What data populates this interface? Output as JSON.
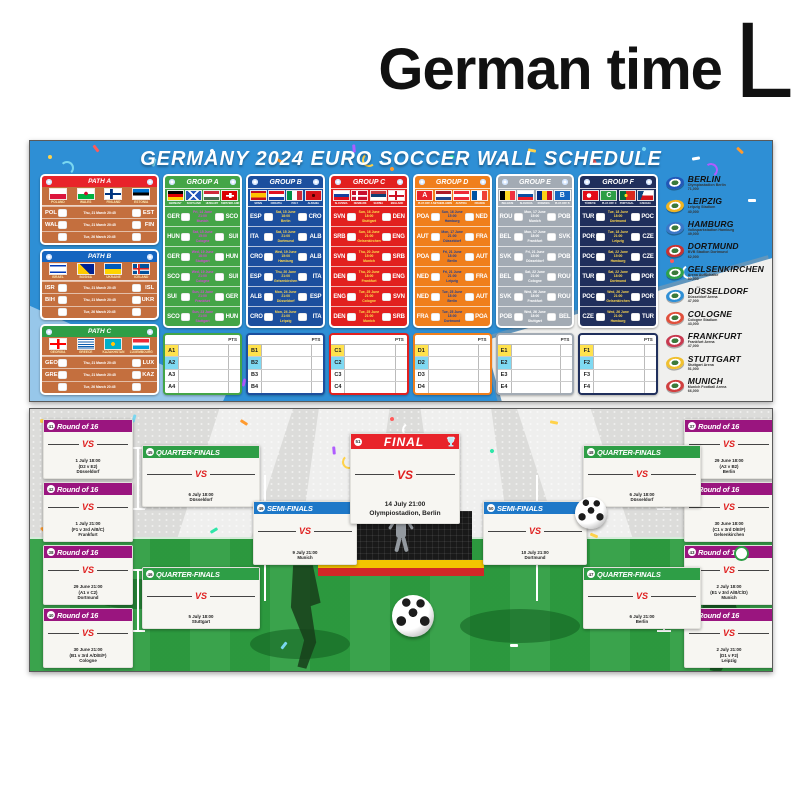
{
  "header": {
    "title": "German time",
    "size": "L"
  },
  "top_banner": {
    "title": "GERMANY 2024 EURO SOCCER WALL SCHEDULE",
    "pts_label": "PTS",
    "paths": [
      {
        "name": "PATH A",
        "color": "#e8232a",
        "flags": [
          {
            "code": "pol",
            "label": "POLAND"
          },
          {
            "code": "wal",
            "label": "WALES"
          },
          {
            "code": "fin",
            "label": "FINLAND"
          },
          {
            "code": "est",
            "label": "ESTONIA"
          }
        ],
        "matches": [
          {
            "home": "POL",
            "away": "EST",
            "info": "Thu, 21 March 20:45"
          },
          {
            "home": "WAL",
            "away": "FIN",
            "info": "Thu, 21 March 20:45"
          },
          {
            "home": "",
            "away": "",
            "info": "Tue, 26 March 20:45"
          }
        ]
      },
      {
        "name": "PATH B",
        "color": "#1565c0",
        "flags": [
          {
            "code": "isr",
            "label": "ISRAEL"
          },
          {
            "code": "bih",
            "label": "BOSNIA"
          },
          {
            "code": "ukr",
            "label": "UKRAINE"
          },
          {
            "code": "isl",
            "label": "ICELAND"
          }
        ],
        "matches": [
          {
            "home": "ISR",
            "away": "ISL",
            "info": "Thu, 21 March 20:45"
          },
          {
            "home": "BIH",
            "away": "UKR",
            "info": "Thu, 21 March 20:45"
          },
          {
            "home": "",
            "away": "",
            "info": "Tue, 26 March 20:45"
          }
        ]
      },
      {
        "name": "PATH C",
        "color": "#2e9e46",
        "flags": [
          {
            "code": "geo",
            "label": "GEORGIA"
          },
          {
            "code": "gre",
            "label": "GREECE"
          },
          {
            "code": "kaz",
            "label": "KAZAKHSTAN"
          },
          {
            "code": "lux",
            "label": "LUXEMBOURG"
          }
        ],
        "matches": [
          {
            "home": "GEO",
            "away": "LUX",
            "info": "Thu, 21 March 20:45"
          },
          {
            "home": "GRE",
            "away": "KAZ",
            "info": "Thu, 21 March 20:45"
          },
          {
            "home": "",
            "away": "",
            "info": "Tue, 26 March 20:45"
          }
        ]
      }
    ],
    "groups": [
      {
        "name": "GROUP A",
        "color": "#44a547",
        "info_color": "#d24ad2",
        "flags": [
          {
            "code": "ger",
            "label": "GERMANY"
          },
          {
            "code": "sco",
            "label": "SCOTLAND"
          },
          {
            "code": "hun",
            "label": "HUNGARY"
          },
          {
            "code": "sui",
            "label": "SWITZERLAND"
          }
        ],
        "matches": [
          {
            "home": "GER",
            "away": "SCO",
            "date": "Fri, 14 June 21:00",
            "venue": "Munich"
          },
          {
            "home": "HUN",
            "away": "SUI",
            "date": "Sat, 15 June 15:00",
            "venue": "Cologne"
          },
          {
            "home": "GER",
            "away": "HUN",
            "date": "Wed, 19 June 18:00",
            "venue": "Stuttgart"
          },
          {
            "home": "SCO",
            "away": "SUI",
            "date": "Wed, 19 June 21:00",
            "venue": "Cologne"
          },
          {
            "home": "SUI",
            "away": "GER",
            "date": "Sun, 23 June 21:00",
            "venue": "Frankfurt"
          },
          {
            "home": "SCO",
            "away": "HUN",
            "date": "Sun, 23 June 21:00",
            "venue": "Stuttgart"
          }
        ],
        "slots": [
          {
            "label": "A1",
            "color": "#ffe24d"
          },
          {
            "label": "A2",
            "color": "#7fd9f2"
          },
          {
            "label": "A3",
            "color": "#ffffff"
          },
          {
            "label": "A4",
            "color": "#ffffff"
          }
        ]
      },
      {
        "name": "GROUP B",
        "color": "#1c4f9e",
        "info_color": "#ffd84d",
        "flags": [
          {
            "code": "esp",
            "label": "SPAIN"
          },
          {
            "code": "cro",
            "label": "CROATIA"
          },
          {
            "code": "ita",
            "label": "ITALY"
          },
          {
            "code": "alb",
            "label": "ALBANIA"
          }
        ],
        "matches": [
          {
            "home": "ESP",
            "away": "CRO",
            "date": "Sat, 15 June 18:00",
            "venue": "Berlin"
          },
          {
            "home": "ITA",
            "away": "ALB",
            "date": "Sat, 15 June 21:00",
            "venue": "Dortmund"
          },
          {
            "home": "CRO",
            "away": "ALB",
            "date": "Wed, 19 June 15:00",
            "venue": "Hamburg"
          },
          {
            "home": "ESP",
            "away": "ITA",
            "date": "Thu, 20 June 21:00",
            "venue": "Gelsenkirchen"
          },
          {
            "home": "ALB",
            "away": "ESP",
            "date": "Mon, 24 June 21:00",
            "venue": "Düsseldorf"
          },
          {
            "home": "CRO",
            "away": "ITA",
            "date": "Mon, 24 June 21:00",
            "venue": "Leipzig"
          }
        ],
        "slots": [
          {
            "label": "B1",
            "color": "#ffe24d"
          },
          {
            "label": "B2",
            "color": "#7fd9f2"
          },
          {
            "label": "B3",
            "color": "#ffffff"
          },
          {
            "label": "B4",
            "color": "#ffffff"
          }
        ]
      },
      {
        "name": "GROUP C",
        "color": "#e2201f",
        "info_color": "#ffe04d",
        "flags": [
          {
            "code": "svn",
            "label": "SLOVENIA"
          },
          {
            "code": "den",
            "label": "DENMARK"
          },
          {
            "code": "srb",
            "label": "SERBIA"
          },
          {
            "code": "eng",
            "label": "ENGLAND"
          }
        ],
        "matches": [
          {
            "home": "SVN",
            "away": "DEN",
            "date": "Sun, 16 June 18:00",
            "venue": "Stuttgart"
          },
          {
            "home": "SRB",
            "away": "ENG",
            "date": "Sun, 16 June 21:00",
            "venue": "Gelsenkirchen"
          },
          {
            "home": "SVN",
            "away": "SRB",
            "date": "Thu, 20 June 15:00",
            "venue": "Munich"
          },
          {
            "home": "DEN",
            "away": "ENG",
            "date": "Thu, 20 June 18:00",
            "venue": "Frankfurt"
          },
          {
            "home": "ENG",
            "away": "SVN",
            "date": "Tue, 25 June 21:00",
            "venue": "Cologne"
          },
          {
            "home": "DEN",
            "away": "SRB",
            "date": "Tue, 25 June 21:00",
            "venue": "Munich"
          }
        ],
        "slots": [
          {
            "label": "C1",
            "color": "#ffe24d"
          },
          {
            "label": "C2",
            "color": "#7fd9f2"
          },
          {
            "label": "C3",
            "color": "#ffffff"
          },
          {
            "label": "C4",
            "color": "#ffffff"
          }
        ]
      },
      {
        "name": "GROUP D",
        "color": "#f07f1c",
        "info_color": "#1c3f94",
        "flags": [
          {
            "code": "poa",
            "label": "PLAY-OFF A"
          },
          {
            "code": "ned",
            "label": "NETHERLANDS"
          },
          {
            "code": "aut",
            "label": "AUSTRIA"
          },
          {
            "code": "fra",
            "label": "FRANCE"
          }
        ],
        "matches": [
          {
            "home": "POA",
            "away": "NED",
            "date": "Sun, 16 June 15:00",
            "venue": "Hamburg"
          },
          {
            "home": "AUT",
            "away": "FRA",
            "date": "Mon, 17 June 21:00",
            "venue": "Düsseldorf"
          },
          {
            "home": "POA",
            "away": "AUT",
            "date": "Fri, 21 June 18:00",
            "venue": "Berlin"
          },
          {
            "home": "NED",
            "away": "FRA",
            "date": "Fri, 21 June 21:00",
            "venue": "Leipzig"
          },
          {
            "home": "NED",
            "away": "AUT",
            "date": "Tue, 25 June 18:00",
            "venue": "Berlin"
          },
          {
            "home": "FRA",
            "away": "POA",
            "date": "Tue, 25 June 18:00",
            "venue": "Dortmund"
          }
        ],
        "slots": [
          {
            "label": "D1",
            "color": "#ffe24d"
          },
          {
            "label": "D2",
            "color": "#7fd9f2"
          },
          {
            "label": "D3",
            "color": "#ffffff"
          },
          {
            "label": "D4",
            "color": "#ffffff"
          }
        ]
      },
      {
        "name": "GROUP E",
        "color": "#a3abb4",
        "info_color": "#ffffff",
        "flags": [
          {
            "code": "bel",
            "label": "BELGIUM"
          },
          {
            "code": "svk",
            "label": "SLOVAKIA"
          },
          {
            "code": "rou",
            "label": "ROMANIA"
          },
          {
            "code": "pob",
            "label": "PLAY-OFF B"
          }
        ],
        "matches": [
          {
            "home": "ROU",
            "away": "POB",
            "date": "Mon, 17 June 15:00",
            "venue": "Munich"
          },
          {
            "home": "BEL",
            "away": "SVK",
            "date": "Mon, 17 June 18:00",
            "venue": "Frankfurt"
          },
          {
            "home": "SVK",
            "away": "POB",
            "date": "Fri, 21 June 15:00",
            "venue": "Düsseldorf"
          },
          {
            "home": "BEL",
            "away": "ROU",
            "date": "Sat, 22 June 21:00",
            "venue": "Cologne"
          },
          {
            "home": "SVK",
            "away": "ROU",
            "date": "Wed, 26 June 18:00",
            "venue": "Frankfurt"
          },
          {
            "home": "POB",
            "away": "BEL",
            "date": "Wed, 26 June 18:00",
            "venue": "Stuttgart"
          }
        ],
        "slots": [
          {
            "label": "E1",
            "color": "#ffe24d"
          },
          {
            "label": "E2",
            "color": "#7fd9f2"
          },
          {
            "label": "E3",
            "color": "#ffffff"
          },
          {
            "label": "E4",
            "color": "#ffffff"
          }
        ]
      },
      {
        "name": "GROUP F",
        "color": "#202f5c",
        "info_color": "#ffd84d",
        "flags": [
          {
            "code": "tur",
            "label": "TÜRKIYE"
          },
          {
            "code": "poc",
            "label": "PLAY-OFF C"
          },
          {
            "code": "por",
            "label": "PORTUGAL"
          },
          {
            "code": "cze",
            "label": "CZECHIA"
          }
        ],
        "matches": [
          {
            "home": "TUR",
            "away": "POC",
            "date": "Tue, 18 June 18:00",
            "venue": "Dortmund"
          },
          {
            "home": "POR",
            "away": "CZE",
            "date": "Tue, 18 June 21:00",
            "venue": "Leipzig"
          },
          {
            "home": "POC",
            "away": "CZE",
            "date": "Sat, 22 June 15:00",
            "venue": "Hamburg"
          },
          {
            "home": "TUR",
            "away": "POR",
            "date": "Sat, 22 June 18:00",
            "venue": "Dortmund"
          },
          {
            "home": "POC",
            "away": "POR",
            "date": "Wed, 26 June 21:00",
            "venue": "Gelsenkirchen"
          },
          {
            "home": "CZE",
            "away": "TUR",
            "date": "Wed, 26 June 21:00",
            "venue": "Hamburg"
          }
        ],
        "slots": [
          {
            "label": "F1",
            "color": "#ffe24d"
          },
          {
            "label": "F2",
            "color": "#7fd9f2"
          },
          {
            "label": "F3",
            "color": "#ffffff"
          },
          {
            "label": "F4",
            "color": "#ffffff"
          }
        ]
      }
    ],
    "cities": [
      {
        "name": "BERLIN",
        "stadium": "Olympiastadion Berlin",
        "capacity": "71,000",
        "icon_color": "#2257b8"
      },
      {
        "name": "LEIPZIG",
        "stadium": "Leipzig Stadium",
        "capacity": "40,000",
        "icon_color": "#f0b421"
      },
      {
        "name": "HAMBURG",
        "stadium": "Volksparkstadion Hamburg",
        "capacity": "49,000",
        "icon_color": "#3a77c8"
      },
      {
        "name": "DORTMUND",
        "stadium": "BVB Stadion Dortmund",
        "capacity": "62,000",
        "icon_color": "#c83232"
      },
      {
        "name": "GELSENKIRCHEN",
        "stadium": "Arena AufSchalke",
        "capacity": "50,000",
        "icon_color": "#2fa14a"
      },
      {
        "name": "DÜSSELDORF",
        "stadium": "Düsseldorf Arena",
        "capacity": "47,000",
        "icon_color": "#2f8fd5"
      },
      {
        "name": "COLOGNE",
        "stadium": "Cologne Stadium",
        "capacity": "43,000",
        "icon_color": "#e0503c"
      },
      {
        "name": "FRANKFURT",
        "stadium": "Frankfurt Arena",
        "capacity": "47,000",
        "icon_color": "#c83a50"
      },
      {
        "name": "STUTTGART",
        "stadium": "Stuttgart Arena",
        "capacity": "51,000",
        "icon_color": "#f0c030"
      },
      {
        "name": "MUNICH",
        "stadium": "Munich Football Arena",
        "capacity": "66,000",
        "icon_color": "#d04040"
      }
    ]
  },
  "bracket": {
    "round16_label": "Round of 16",
    "qf_label": "QUARTER-FINALS",
    "sf_label": "SEMI-FINALS",
    "final_label": "FINAL",
    "vs": "VS",
    "r16_left": [
      {
        "num": "41",
        "date": "1 July 18:00",
        "pairing": "(D2 v E2)",
        "city": "Düsseldorf"
      },
      {
        "num": "42",
        "date": "1 July 21:00",
        "pairing": "(F1 v 3rd A/B/C)",
        "city": "Frankfurt"
      },
      {
        "num": "38",
        "date": "29 June 21:00",
        "pairing": "(A1 v C2)",
        "city": "Dortmund"
      },
      {
        "num": "40",
        "date": "30 June 21:00",
        "pairing": "(B1 v 3rd A/D/E/F)",
        "city": "Cologne"
      }
    ],
    "r16_right": [
      {
        "num": "37",
        "date": "29 June 18:00",
        "pairing": "(A2 v B2)",
        "city": "Berlin"
      },
      {
        "num": "39",
        "date": "30 June 18:00",
        "pairing": "(C1 v 3rd D/E/F)",
        "city": "Gelsenkirchen"
      },
      {
        "num": "43",
        "date": "2 July 18:00",
        "pairing": "(E1 v 3rd A/B/C/D)",
        "city": "Munich"
      },
      {
        "num": "44",
        "date": "2 July 21:00",
        "pairing": "(D1 v F2)",
        "city": "Leipzig"
      }
    ],
    "qf_left": [
      {
        "num": "45",
        "date": "6 July 18:00",
        "city": "Düsseldorf"
      },
      {
        "num": "46",
        "date": "5 July 18:00",
        "city": "Stuttgart"
      }
    ],
    "qf_right": [
      {
        "num": "48",
        "date": "6 July 18:00",
        "city": "Düsseldorf"
      },
      {
        "num": "47",
        "date": "6 July 21:00",
        "city": "Berlin"
      }
    ],
    "sf_left": {
      "num": "49",
      "date": "9 July 21:00",
      "city": "Munich"
    },
    "sf_right": {
      "num": "50",
      "date": "10 July 21:00",
      "city": "Dortmund"
    },
    "final": {
      "num": "51",
      "date": "14 July 21:00",
      "venue": "Olympiostadion, Berlin"
    }
  }
}
